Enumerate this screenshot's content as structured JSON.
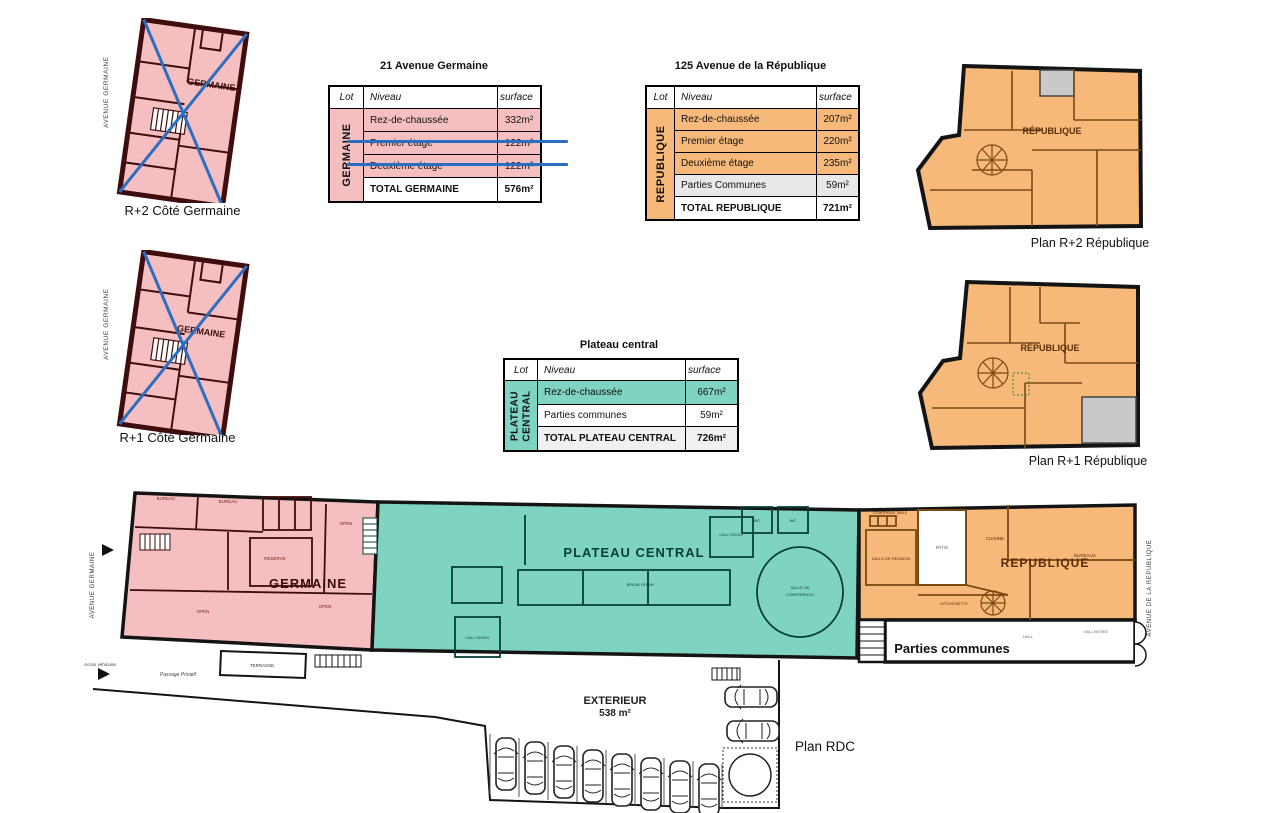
{
  "colors": {
    "pink": "#f5bfc2",
    "pink_wall": "#3f0d0d",
    "teal": "#7fd3c1",
    "teal_wall": "#063f38",
    "orange": "#f7b979",
    "orange_wall": "#7a4a12",
    "blue_strike": "#2a6fbf",
    "gray_room": "#c9c9c9",
    "gray_row": "#e8e8e8"
  },
  "tables": {
    "germaine": {
      "title": "21 Avenue Germaine",
      "lot": "GERMAINE",
      "headers": {
        "lot": "Lot",
        "niveau": "Niveau",
        "surface": "surface"
      },
      "rows": [
        {
          "niveau": "Rez-de-chaussée",
          "surface": "332m²"
        },
        {
          "niveau": "Premier étage",
          "surface": "122m²"
        },
        {
          "niveau": "Deuxième étage",
          "surface": "122m²"
        }
      ],
      "total": {
        "label": "TOTAL GERMAINE",
        "surface": "576m²"
      }
    },
    "republique": {
      "title": "125 Avenue de la République",
      "lot": "REPUBLIQUE",
      "headers": {
        "lot": "Lot",
        "niveau": "Niveau",
        "surface": "surface"
      },
      "rows": [
        {
          "niveau": "Rez-de-chaussée",
          "surface": "207m²"
        },
        {
          "niveau": "Premier étage",
          "surface": "220m²"
        },
        {
          "niveau": "Deuxième étage",
          "surface": "235m²"
        },
        {
          "niveau": "Parties Communes",
          "surface": "59m²"
        }
      ],
      "total": {
        "label": "TOTAL REPUBLIQUE",
        "surface": "721m²"
      }
    },
    "plateau": {
      "title": "Plateau central",
      "lot": "PLATEAU CENTRAL",
      "headers": {
        "lot": "Lot",
        "niveau": "Niveau",
        "surface": "surface"
      },
      "rows": [
        {
          "niveau": "Rez-de-chaussée",
          "surface": "667m²"
        },
        {
          "niveau": "Parties communes",
          "surface": "59m²"
        }
      ],
      "total": {
        "label": "TOTAL PLATEAU CENTRAL",
        "surface": "726m²"
      }
    }
  },
  "plans": {
    "r2g": {
      "caption": "R+2 Côté Germaine",
      "street": "AVENUE GERMAINE",
      "label": "GERMAINE"
    },
    "r1g": {
      "caption": "R+1 Côté Germaine",
      "street": "AVENUE GERMAINE",
      "label": "GERMAINE"
    },
    "r2r": {
      "caption": "Plan R+2 République",
      "label": "RÉPUBLIQUE"
    },
    "r1r": {
      "caption": "Plan R+1 République",
      "label": "RÉPUBLIQUE"
    }
  },
  "rdc": {
    "caption": "Plan RDC",
    "germaine": "GERMAINE",
    "plateau": "PLATEAU CENTRAL",
    "republique": "REPUBLIQUE",
    "parties": "Parties communes",
    "exterieur": "EXTERIEUR",
    "exterieur_surface": "538 m²",
    "street_left": "AVENUE GERMAINE",
    "street_right": "AVENUE DE LA REPUBLIQUE",
    "rooms": {
      "bureau": "BUREAU",
      "open": "OPEN",
      "reserve": "RESERVE",
      "call_room": "CALL ROOM",
      "break_room": "BREAK ROOM",
      "salle_conf_1": "SALLE DE",
      "salle_conf_2": "CONFERENCE",
      "salle_reunion": "SALLE DE REUNION",
      "coworking": "COWORKING TABLE",
      "cuisine": "CUISINE",
      "kitchenette": "KITCHENETTE",
      "patio": "PATIO",
      "terrasse": "TERRASSE",
      "wc": "WC",
      "hall": "HALL",
      "hall_entree": "HALL ENTREE",
      "bureaux": "BUREAUX"
    },
    "annotations": {
      "passage": "Passage Privatif",
      "acces": "Accès véhicules"
    }
  }
}
